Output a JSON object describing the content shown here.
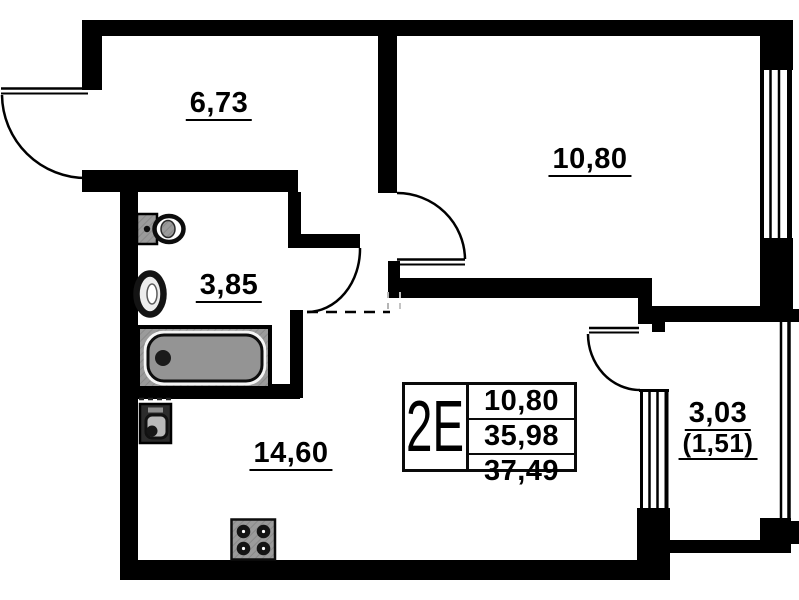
{
  "plan": {
    "unit": {
      "type_label": "2E",
      "area_living": "10,80",
      "area_reduced": "35,98",
      "area_total": "37,49"
    },
    "rooms": {
      "hallway": "6,73",
      "bedroom": "10,80",
      "bathroom": "3,85",
      "kitchen_living": "14,60",
      "balcony": "3,03",
      "balcony_reduced": "(1,51)"
    },
    "fixtures": [
      "toilet",
      "sink",
      "bathtub",
      "washing-machine",
      "stove"
    ],
    "colors": {
      "wall": "#000000",
      "background": "#ffffff",
      "fixture_gray": "#9b9b9b"
    }
  }
}
